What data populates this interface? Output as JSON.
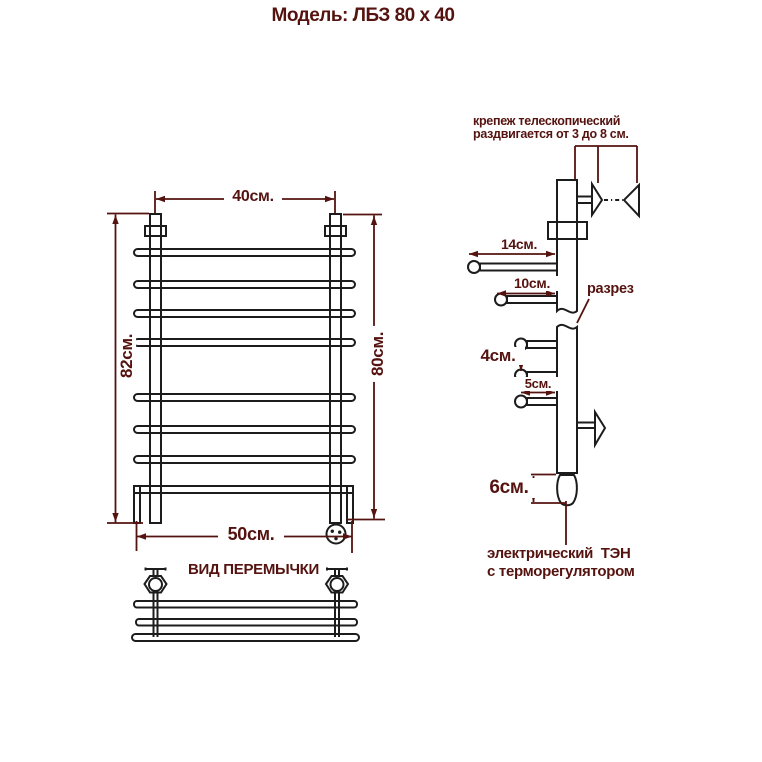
{
  "title": "Модель: ЛБЗ 80 х 40",
  "colors": {
    "accent": "#551310",
    "line": "#1c1c1c",
    "background": "#ffffff"
  },
  "front_view": {
    "width_top": "40см.",
    "height_left": "82см.",
    "height_right": "80см.",
    "width_bottom": "50см."
  },
  "crossbar_view": {
    "title": "ВИД ПЕРЕМЫЧКИ"
  },
  "side_view": {
    "mount_note_line1": "крепеж телескопический",
    "mount_note_line2": "раздвигается от 3 до 8 см.",
    "rail_depth_1": "14см.",
    "rail_depth_2": "10см.",
    "section_label": "разрез",
    "rail_gap": "4см.",
    "rail_depth_3": "5см.",
    "heater_height": "6см.",
    "heater_note_line1": "электрический  ТЭН",
    "heater_note_line2": "с терморегулятором"
  }
}
